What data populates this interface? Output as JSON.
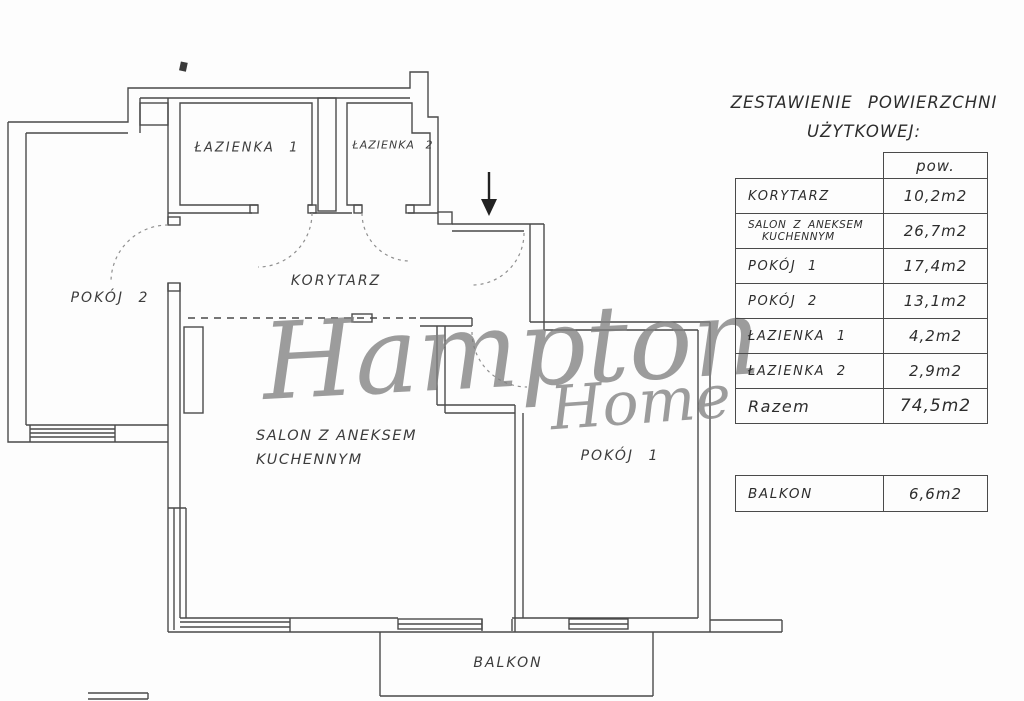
{
  "watermark": {
    "line1": "Hampton",
    "line2": "Home"
  },
  "plan": {
    "labels": {
      "lazienka1": "ŁAZIENKA 1",
      "lazienka2": "ŁAZIENKA 2",
      "pokoj2": "POKÓJ 2",
      "korytarz": "KORYTARZ",
      "salon_line1": "SALON Z ANEKSEM",
      "salon_line2": "KUCHENNYM",
      "pokoj1": "POKÓJ 1",
      "balkon": "BALKON"
    }
  },
  "summary": {
    "title_line1": "ZESTAWIENIE POWIERZCHNI",
    "title_line2": "UŻYTKOWEJ:",
    "col_header": "pow.",
    "rows": [
      {
        "label": "KORYTARZ",
        "value": "10,2m2"
      },
      {
        "label": "SALON Z ANEKSEM",
        "label2": "KUCHENNYM",
        "value": "26,7m2"
      },
      {
        "label": "POKÓJ 1",
        "value": "17,4m2"
      },
      {
        "label": "POKÓJ 2",
        "value": "13,1m2"
      },
      {
        "label": "ŁAZIENKA 1",
        "value": "4,2m2"
      },
      {
        "label": "ŁAZIENKA 2",
        "value": "2,9m2"
      }
    ],
    "total": {
      "label": "Razem",
      "value": "74,5m2"
    },
    "balcony": {
      "label": "BALKON",
      "value": "6,6m2"
    }
  }
}
